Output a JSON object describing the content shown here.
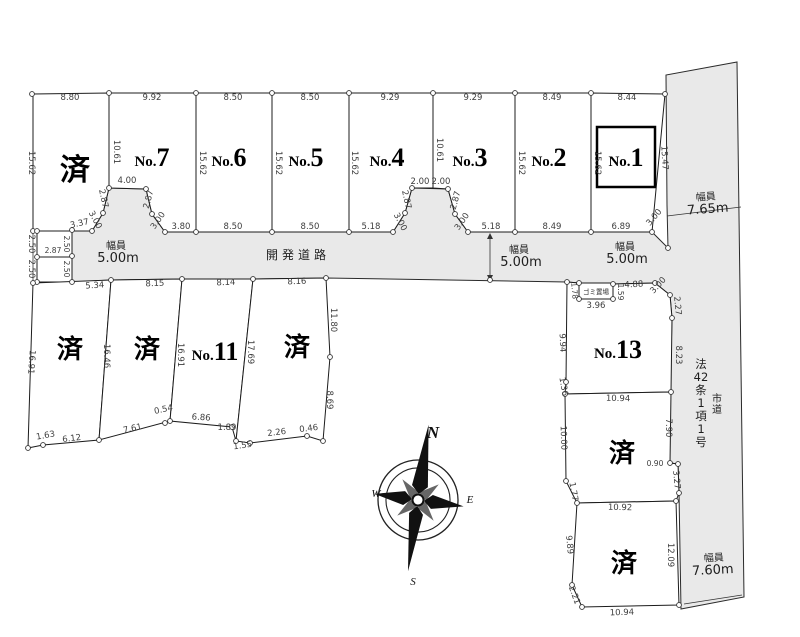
{
  "compass": {
    "n": "N",
    "e": "E",
    "s": "S",
    "w": "W"
  },
  "plot_labels": [
    {
      "main": "済",
      "x": 75,
      "y": 180,
      "s": 30
    },
    {
      "pre": "No.",
      "main": "7",
      "x": 152,
      "y": 166
    },
    {
      "pre": "No.",
      "main": "6",
      "x": 229,
      "y": 166
    },
    {
      "pre": "No.",
      "main": "5",
      "x": 306,
      "y": 166
    },
    {
      "pre": "No.",
      "main": "4",
      "x": 387,
      "y": 166
    },
    {
      "pre": "No.",
      "main": "3",
      "x": 470,
      "y": 166
    },
    {
      "pre": "No.",
      "main": "2",
      "x": 549,
      "y": 166
    },
    {
      "pre": "No.",
      "main": "1",
      "x": 626,
      "y": 166
    },
    {
      "main": "済",
      "x": 70,
      "y": 358,
      "s": 26
    },
    {
      "main": "済",
      "x": 147,
      "y": 358,
      "s": 26
    },
    {
      "pre": "No.",
      "main": "11",
      "x": 215,
      "y": 360
    },
    {
      "main": "済",
      "x": 297,
      "y": 356,
      "s": 26
    },
    {
      "pre": "No.",
      "main": "13",
      "x": 618,
      "y": 358
    },
    {
      "main": "済",
      "x": 622,
      "y": 462,
      "s": 26
    },
    {
      "main": "済",
      "x": 624,
      "y": 572,
      "s": 26
    }
  ],
  "road_labels": [
    {
      "t": "幅員",
      "x": 116,
      "y": 249,
      "s": 10
    },
    {
      "t": "5.00m",
      "x": 118,
      "y": 262,
      "s": 13
    },
    {
      "t": "開発道路",
      "x": 298,
      "y": 259,
      "s": 12,
      "ls": 4
    },
    {
      "t": "幅員",
      "x": 519,
      "y": 253,
      "s": 10
    },
    {
      "t": "5.00m",
      "x": 521,
      "y": 266,
      "s": 13
    },
    {
      "t": "幅員",
      "x": 625,
      "y": 250,
      "s": 10
    },
    {
      "t": "5.00m",
      "x": 627,
      "y": 263,
      "s": 13
    },
    {
      "t": "幅員",
      "x": 706,
      "y": 200,
      "s": 10,
      "r": -4
    },
    {
      "t": "7.65m",
      "x": 708,
      "y": 213,
      "s": 13,
      "r": -4
    },
    {
      "t": "幅員",
      "x": 714,
      "y": 561,
      "s": 10,
      "r": -3
    },
    {
      "t": "7.60m",
      "x": 713,
      "y": 574,
      "s": 13,
      "r": -3
    },
    {
      "t": "ゴミ置場",
      "x": 596,
      "y": 294,
      "s": 6.5
    }
  ],
  "vertical_texts": [
    {
      "t": "法|42|条|1|項|1|号",
      "x": 701,
      "y": 368,
      "lh": 13,
      "s": 11.5
    },
    {
      "t": "市|道",
      "x": 717,
      "y": 402,
      "lh": 11,
      "s": 10
    }
  ],
  "measurements": [
    {
      "t": "8.80",
      "x": 70,
      "y": 100
    },
    {
      "t": "9.92",
      "x": 152,
      "y": 100
    },
    {
      "t": "8.50",
      "x": 233,
      "y": 100
    },
    {
      "t": "8.50",
      "x": 310,
      "y": 100
    },
    {
      "t": "9.29",
      "x": 390,
      "y": 100
    },
    {
      "t": "9.29",
      "x": 473,
      "y": 100
    },
    {
      "t": "8.49",
      "x": 552,
      "y": 100
    },
    {
      "t": "8.44",
      "x": 627,
      "y": 100
    },
    {
      "t": "15.62",
      "x": 29,
      "y": 163,
      "r": 90
    },
    {
      "t": "10.61",
      "x": 114,
      "y": 152,
      "r": 90
    },
    {
      "t": "15.62",
      "x": 200,
      "y": 163,
      "r": 90
    },
    {
      "t": "15.62",
      "x": 276,
      "y": 163,
      "r": 90
    },
    {
      "t": "15.62",
      "x": 352,
      "y": 163,
      "r": 90
    },
    {
      "t": "10.61",
      "x": 437,
      "y": 150,
      "r": 90
    },
    {
      "t": "15.62",
      "x": 519,
      "y": 163,
      "r": 90
    },
    {
      "t": "15.62",
      "x": 595,
      "y": 163,
      "r": 90
    },
    {
      "t": "15.47",
      "x": 662,
      "y": 158,
      "r": 87
    },
    {
      "t": "3.37",
      "x": 80,
      "y": 226,
      "r": -12
    },
    {
      "t": "3.00",
      "x": 93,
      "y": 221,
      "r": 62
    },
    {
      "t": "2.87",
      "x": 101,
      "y": 199,
      "r": 78
    },
    {
      "t": "4.00",
      "x": 127,
      "y": 183
    },
    {
      "t": "2.87",
      "x": 151,
      "y": 200,
      "r": -75
    },
    {
      "t": "3.00",
      "x": 160,
      "y": 222,
      "r": -55
    },
    {
      "t": "3.80",
      "x": 181,
      "y": 229
    },
    {
      "t": "8.50",
      "x": 233,
      "y": 229
    },
    {
      "t": "8.50",
      "x": 310,
      "y": 229
    },
    {
      "t": "5.18",
      "x": 371,
      "y": 229
    },
    {
      "t": "3.00",
      "x": 398,
      "y": 223,
      "r": 62
    },
    {
      "t": "2.87",
      "x": 404,
      "y": 200,
      "r": 78
    },
    {
      "t": "2.00",
      "x": 420,
      "y": 184
    },
    {
      "t": "2.00",
      "x": 441,
      "y": 184
    },
    {
      "t": "2.87",
      "x": 458,
      "y": 201,
      "r": -75
    },
    {
      "t": "3.00",
      "x": 464,
      "y": 223,
      "r": -55
    },
    {
      "t": "5.18",
      "x": 491,
      "y": 229
    },
    {
      "t": "8.49",
      "x": 552,
      "y": 229
    },
    {
      "t": "6.89",
      "x": 621,
      "y": 229
    },
    {
      "t": "3.00",
      "x": 656,
      "y": 219,
      "r": -50
    },
    {
      "t": "2.50",
      "x": 29,
      "y": 244,
      "r": 90
    },
    {
      "t": "2.50",
      "x": 29,
      "y": 269,
      "r": 90
    },
    {
      "t": "2.87",
      "x": 53,
      "y": 253,
      "s": 7.5
    },
    {
      "t": "2.50",
      "x": 64,
      "y": 244,
      "r": 90,
      "s": 7.5
    },
    {
      "t": "2.50",
      "x": 64,
      "y": 269,
      "r": 90,
      "s": 7.5
    },
    {
      "t": "5.34",
      "x": 95,
      "y": 288,
      "r": -4
    },
    {
      "t": "8.15",
      "x": 155,
      "y": 286,
      "r": -2
    },
    {
      "t": "8.14",
      "x": 226,
      "y": 285,
      "r": -2
    },
    {
      "t": "8.16",
      "x": 297,
      "y": 284,
      "r": -2
    },
    {
      "t": "16.91",
      "x": 29,
      "y": 362,
      "r": 94
    },
    {
      "t": "16.46",
      "x": 104,
      "y": 356,
      "r": 90
    },
    {
      "t": "16.91",
      "x": 178,
      "y": 355,
      "r": 90
    },
    {
      "t": "17.69",
      "x": 248,
      "y": 352,
      "r": 90
    },
    {
      "t": "11.80",
      "x": 331,
      "y": 320,
      "r": 90
    },
    {
      "t": "8.69",
      "x": 327,
      "y": 400,
      "r": 90
    },
    {
      "t": "1.63",
      "x": 46,
      "y": 438,
      "r": -10
    },
    {
      "t": "6.12",
      "x": 72,
      "y": 441,
      "r": -7
    },
    {
      "t": "7.61",
      "x": 133,
      "y": 431,
      "r": -12
    },
    {
      "t": "0.54",
      "x": 164,
      "y": 412,
      "r": -12
    },
    {
      "t": "6.86",
      "x": 201,
      "y": 420,
      "r": 4
    },
    {
      "t": "1.89",
      "x": 227,
      "y": 430
    },
    {
      "t": "1.55",
      "x": 243,
      "y": 448,
      "r": -8
    },
    {
      "t": "2.26",
      "x": 277,
      "y": 435,
      "r": -7
    },
    {
      "t": "0.46",
      "x": 309,
      "y": 431,
      "r": -7
    },
    {
      "t": "1.78",
      "x": 572,
      "y": 291,
      "r": 85,
      "s": 7.5
    },
    {
      "t": "3.96",
      "x": 596,
      "y": 308
    },
    {
      "t": "1.59",
      "x": 618,
      "y": 292,
      "r": 90,
      "s": 7.5
    },
    {
      "t": "4.88",
      "x": 634,
      "y": 287,
      "r": -3
    },
    {
      "t": "3.00",
      "x": 660,
      "y": 287,
      "r": -48
    },
    {
      "t": "9.94",
      "x": 560,
      "y": 343,
      "r": 88
    },
    {
      "t": "2.27",
      "x": 675,
      "y": 306,
      "r": 85
    },
    {
      "t": "8.23",
      "x": 676,
      "y": 355,
      "r": 90
    },
    {
      "t": "1.36",
      "x": 561,
      "y": 387,
      "r": 80
    },
    {
      "t": "10.94",
      "x": 618,
      "y": 401,
      "r": 1
    },
    {
      "t": "10.00",
      "x": 561,
      "y": 438,
      "r": 88
    },
    {
      "t": "7.90",
      "x": 666,
      "y": 428,
      "r": 90
    },
    {
      "t": "0.90",
      "x": 655,
      "y": 466,
      "s": 7.5
    },
    {
      "t": "3.27",
      "x": 674,
      "y": 480,
      "r": 85
    },
    {
      "t": "1.77",
      "x": 571,
      "y": 492,
      "r": 80
    },
    {
      "t": "10.92",
      "x": 620,
      "y": 510,
      "r": 1
    },
    {
      "t": "9.89",
      "x": 567,
      "y": 545,
      "r": 84
    },
    {
      "t": "2.21",
      "x": 572,
      "y": 596,
      "r": 70
    },
    {
      "t": "12.09",
      "x": 668,
      "y": 555,
      "r": 90
    },
    {
      "t": "10.94",
      "x": 622,
      "y": 615,
      "r": -2
    }
  ]
}
